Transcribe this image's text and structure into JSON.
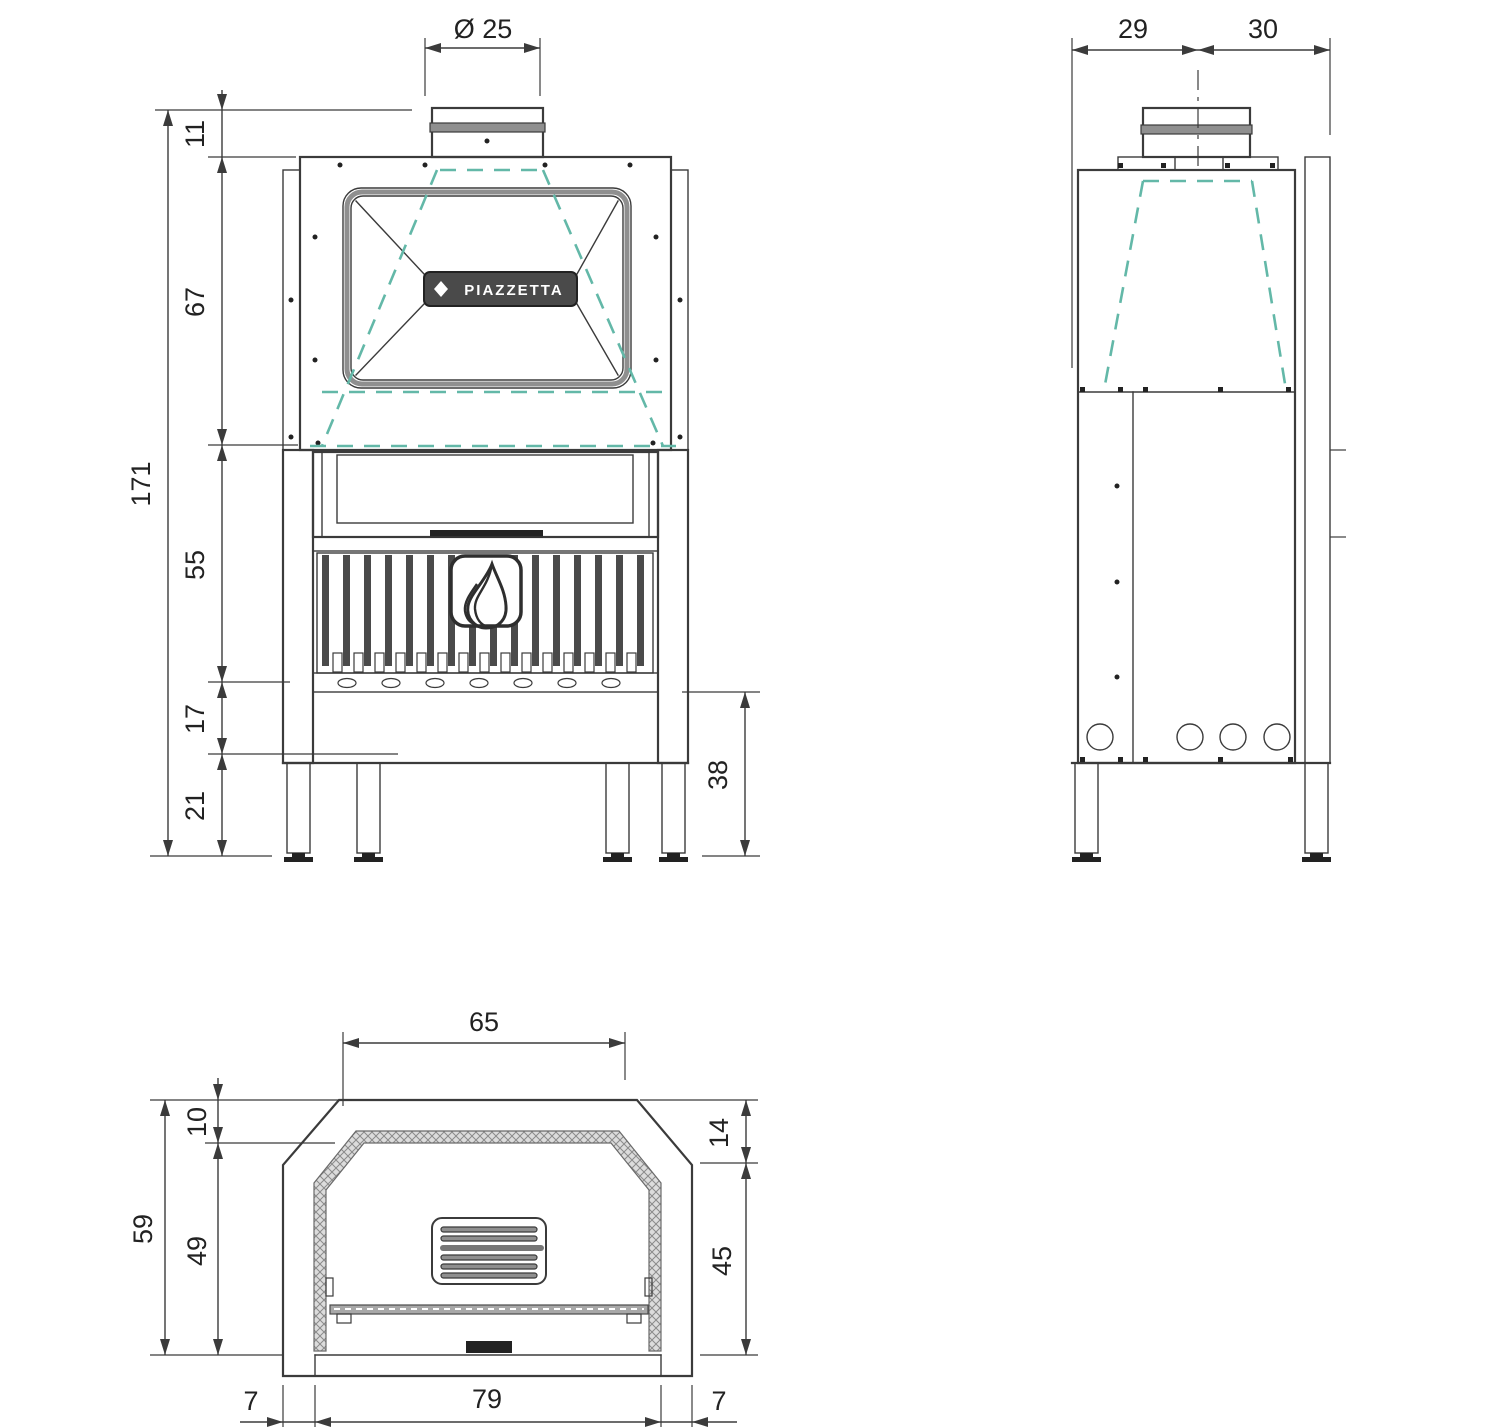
{
  "title": "Fireplace technical drawing",
  "brand": "PIAZZETTA",
  "views": {
    "front": {
      "label": "front view",
      "dims": {
        "flue_diameter": "Ø 25",
        "top_offset": "11",
        "hood_height": "67",
        "firebox_height": "55",
        "base_height": "17",
        "leg_height": "21",
        "total_height": "171",
        "plinth_height": "38"
      }
    },
    "side": {
      "label": "side view",
      "dims": {
        "depth_front": "29",
        "depth_rear": "30"
      }
    },
    "plan": {
      "label": "top view",
      "dims": {
        "opening_width": "65",
        "total_depth": "59",
        "rear_offset": "10",
        "inner_depth": "49",
        "front_offset": "14",
        "side_depth": "45",
        "left_wall": "7",
        "front_width": "79",
        "right_wall": "7"
      }
    }
  },
  "colors": {
    "line": "#3b3b3b",
    "accent_dashed": "#63b8a8",
    "band_fill": "#8f8f8f",
    "plaque_fill": "#4a4a4a"
  }
}
